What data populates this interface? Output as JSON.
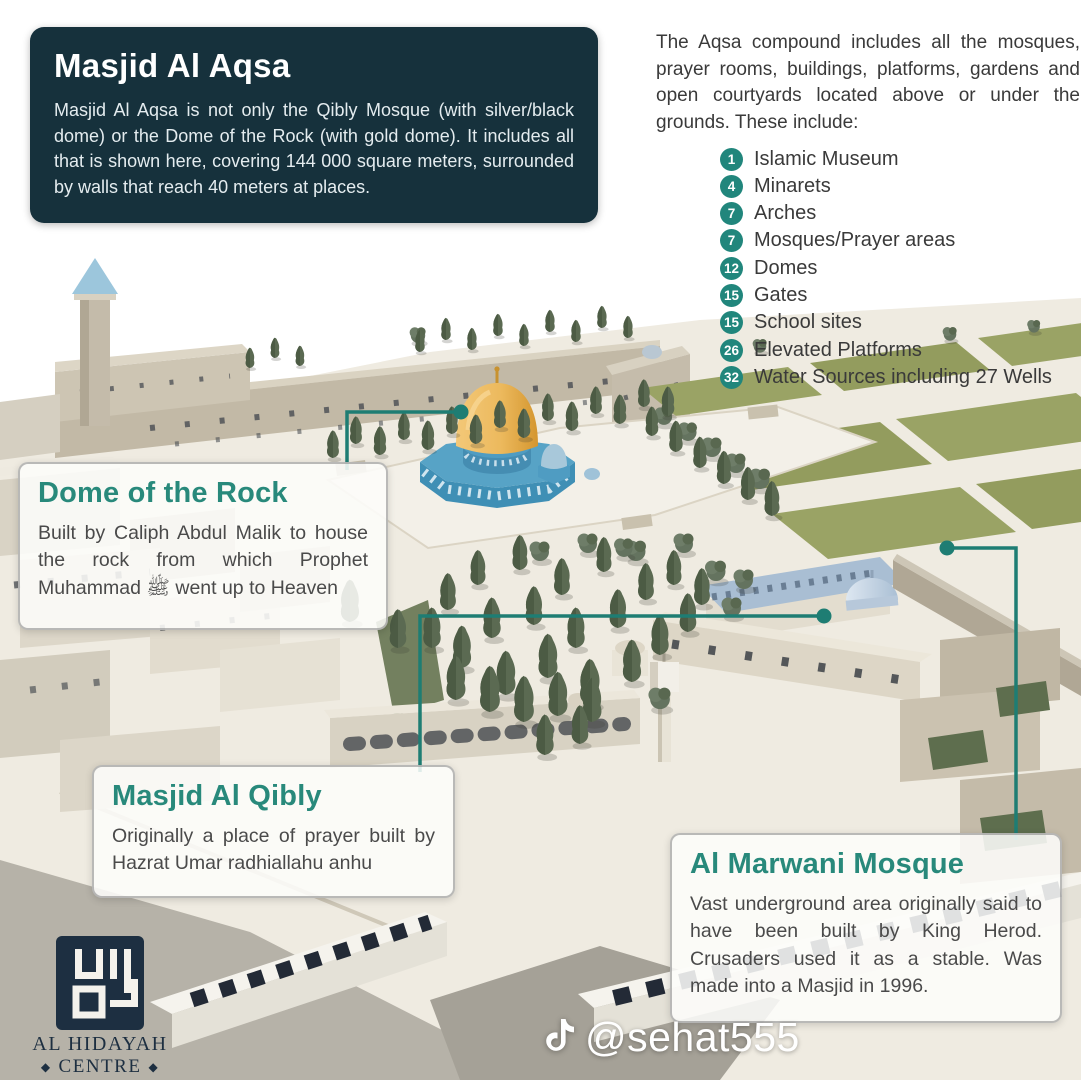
{
  "colors": {
    "panel_dark": "#16313c",
    "heading_teal": "#28897b",
    "badge_teal": "#21867c",
    "leader_line_teal": "#1e7d73",
    "dome_gold": "#ecb95d",
    "dome_blue": "#4796bc",
    "lawn_green": "#9aa365"
  },
  "intro_panel": {
    "title": "Masjid Al Aqsa",
    "body": "Masjid Al Aqsa is not only the Qibly Mosque (with silver/black dome) or the Dome of the Rock (with gold dome). It includes all that is shown here, covering 144 000 square meters, surrounded by walls that reach 40 meters at places."
  },
  "compound_info": {
    "intro": "The Aqsa compound includes all the mosques, prayer rooms, buildings, platforms, gardens and open courtyards located above or under the grounds. These include:",
    "items": [
      {
        "count": "1",
        "label": "Islamic Museum"
      },
      {
        "count": "4",
        "label": "Minarets"
      },
      {
        "count": "7",
        "label": "Arches"
      },
      {
        "count": "7",
        "label": "Mosques/Prayer areas"
      },
      {
        "count": "12",
        "label": "Domes"
      },
      {
        "count": "15",
        "label": "Gates"
      },
      {
        "count": "15",
        "label": "School sites"
      },
      {
        "count": "26",
        "label": "Elevated Platforms"
      },
      {
        "count": "32",
        "label": "Water Sources including 27 Wells"
      }
    ]
  },
  "callouts": {
    "dome_of_the_rock": {
      "title": "Dome of the Rock",
      "body": "Built by Caliph Abdul Malik to house the rock from which Prophet Muhammad ﷺ went up to Heaven"
    },
    "masjid_al_qibly": {
      "title": "Masjid Al Qibly",
      "body": "Originally a place of prayer built by Hazrat Umar radhiallahu anhu"
    },
    "al_marwani": {
      "title": "Al Marwani Mosque",
      "body": "Vast underground area originally said to have been built by King Herod. Crusaders used it as a stable. Was made into a Masjid in 1996."
    }
  },
  "logo": {
    "name": "AL HIDAYAH",
    "centre": "CENTRE",
    "diamond": "◆",
    "region": "EASTERN CAPE"
  },
  "social": {
    "handle": "@sehat555"
  }
}
